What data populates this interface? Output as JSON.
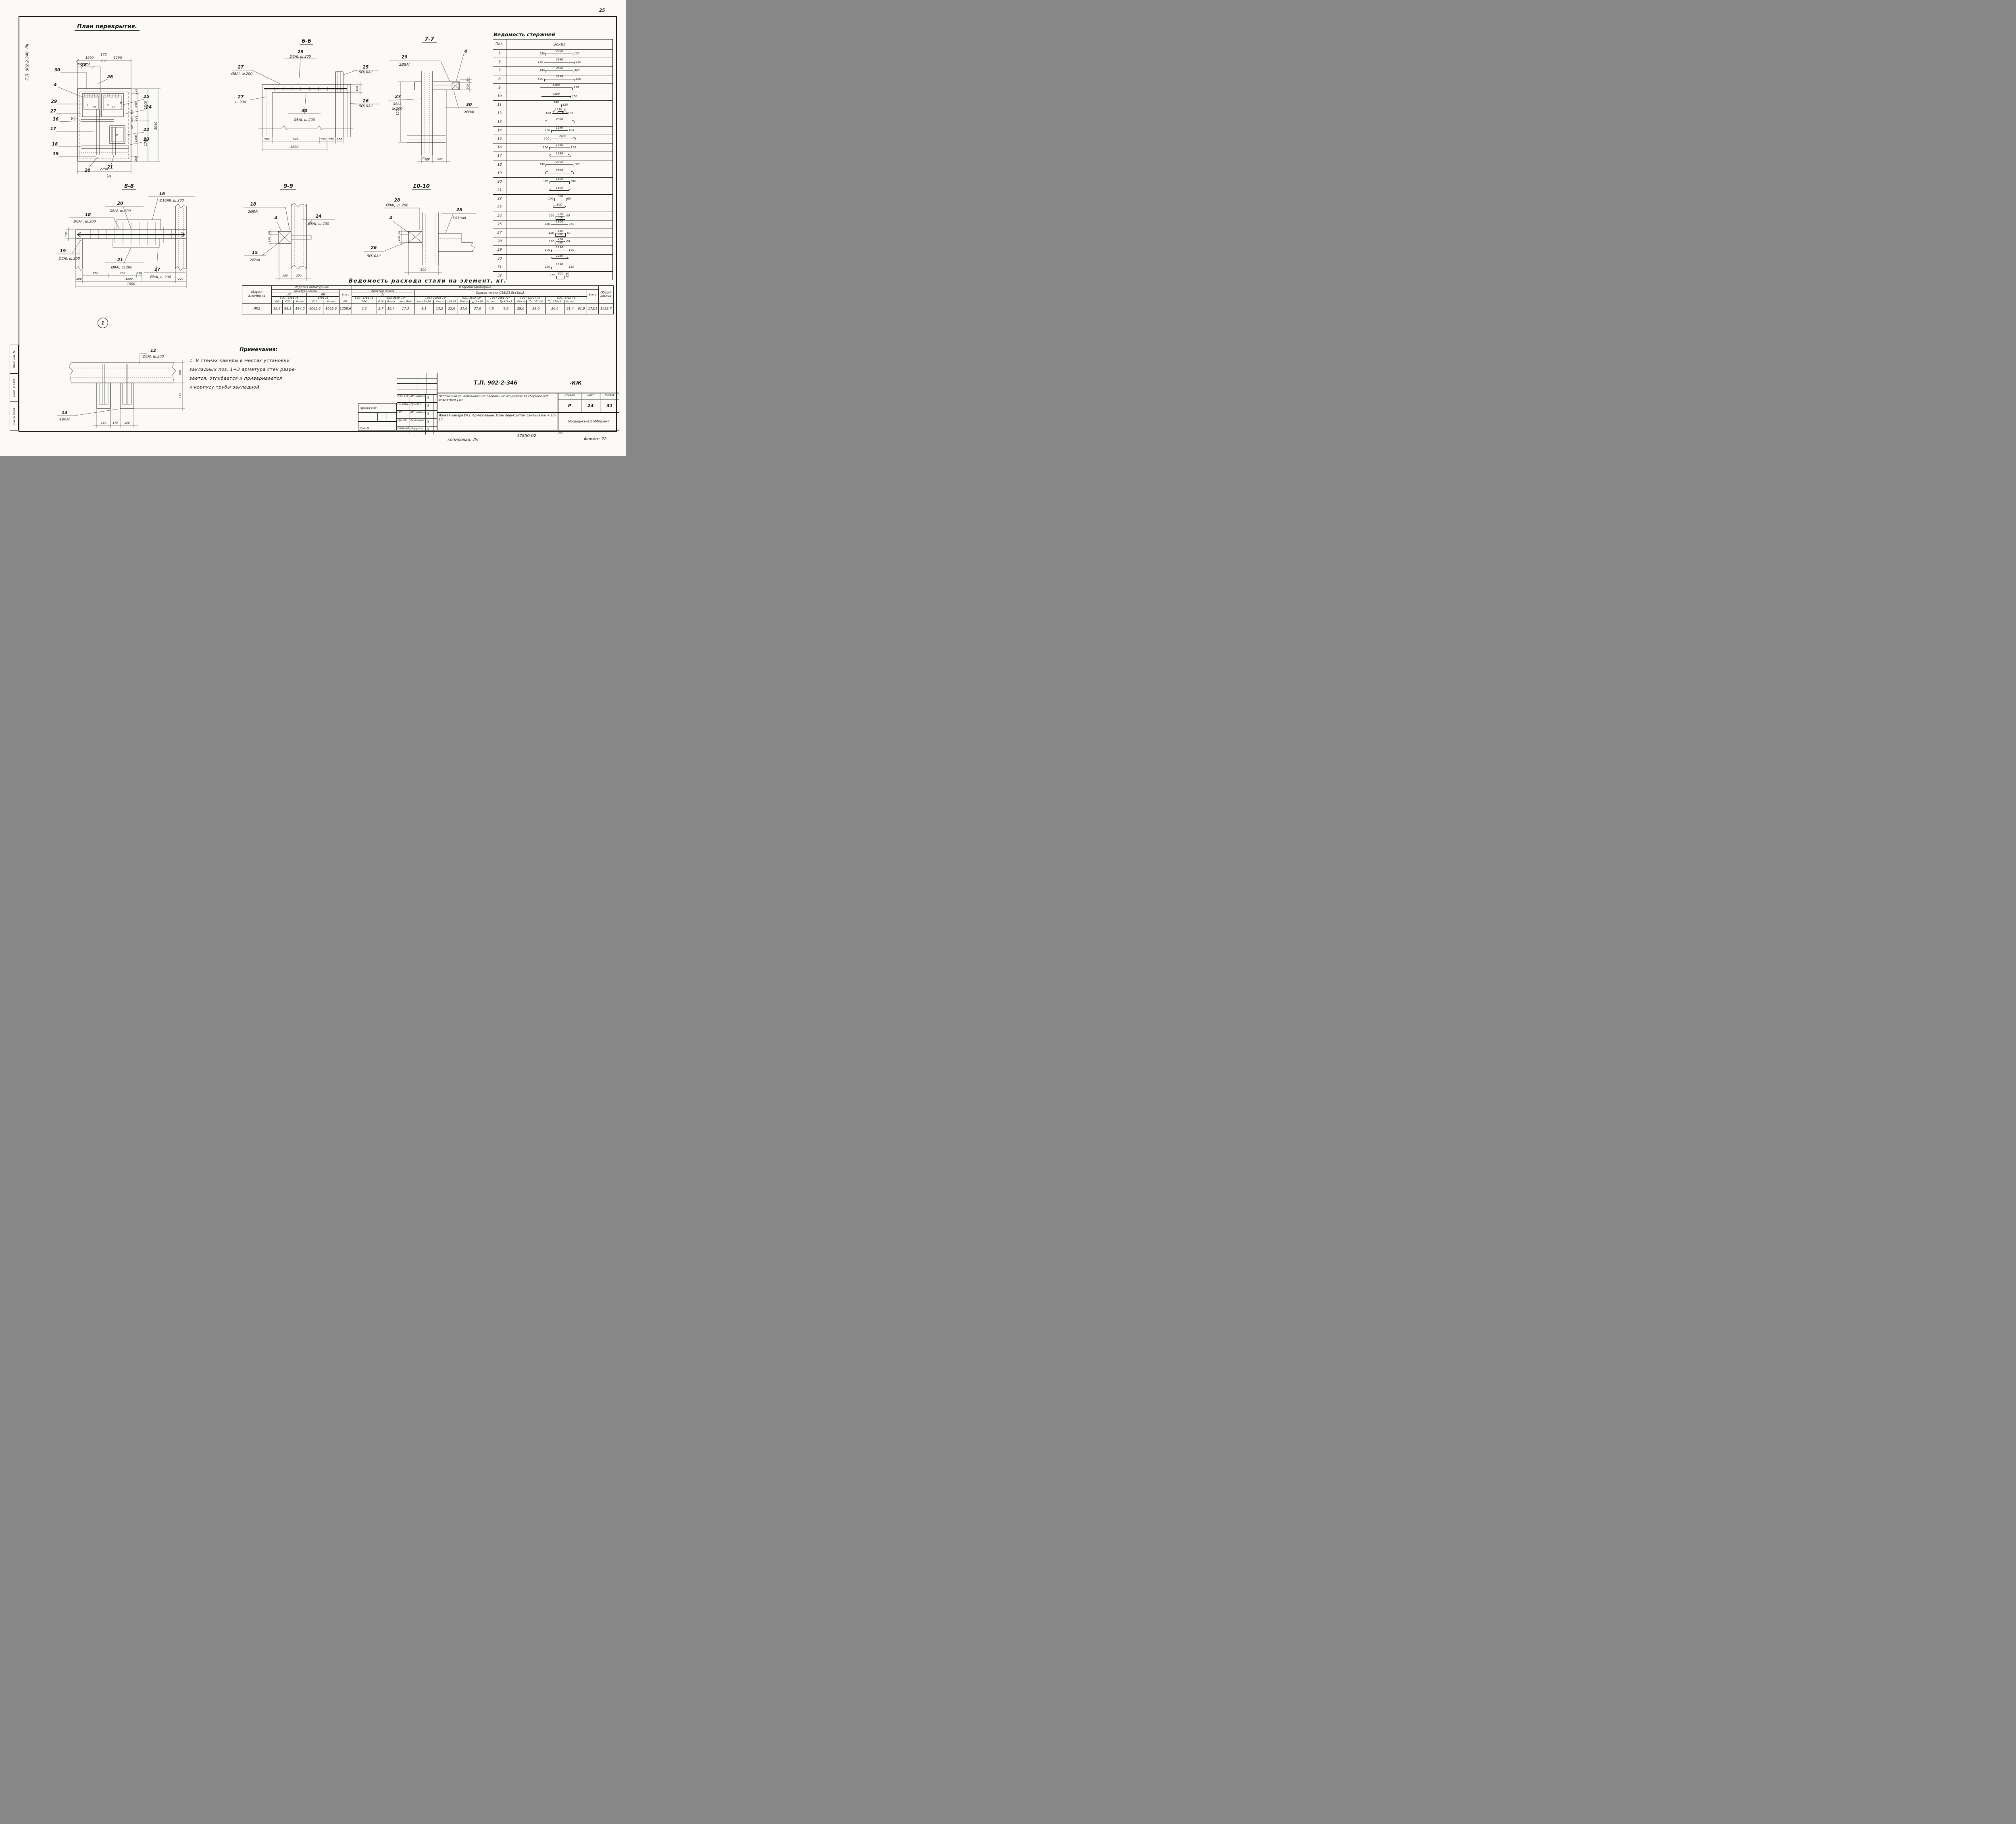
{
  "page": {
    "number": "25",
    "stamp": "-Т.П. 902-2-346. ЛII",
    "margin": [
      "Взам. инв. №",
      "Подп. и дата",
      "Инв. № подл."
    ],
    "footer": {
      "copied": "копировал: Лs",
      "order": "17850-02",
      "num": "26",
      "format": "Формат 22"
    }
  },
  "plan": {
    "title": "План перекрытия.",
    "balloon": "1",
    "callouts": {
      "30": "30",
      "28": "28",
      "26": "26",
      "4": "4",
      "29": "29",
      "27": "27",
      "25": "25",
      "24": "24",
      "22": "22",
      "23": "23",
      "16": "16",
      "17": "17",
      "18": "18",
      "19": "19",
      "20": "20",
      "21": "21"
    },
    "marks": {
      "m6": "6",
      "m8": "8",
      "b7": "7",
      "b8": "8",
      "b9": "9",
      "b9b": "9",
      "b10": "10",
      "b10b": "10"
    },
    "dims": {
      "top": [
        "1290",
        "170",
        "1290"
      ],
      "top2": [
        "200",
        "700"
      ],
      "right": [
        "200",
        "940",
        "200",
        "1500",
        "200"
      ],
      "mid": [
        "1340",
        "1700"
      ],
      "total": "3040",
      "bottom": "2750",
      "inner": [
        "150",
        "700",
        "200"
      ]
    }
  },
  "s66": {
    "title": "6-6",
    "a29": "29",
    "a29s": "Ø8AI, ш.200",
    "a27": "27",
    "a27s": "Ø8AI, ш.200",
    "a27b": "27",
    "a27bs": "ш.200",
    "a25": "25",
    "a25s": "5Ø10AII",
    "a26": "26",
    "a26s": "5Ø10AII",
    "a30": "30",
    "a30s": "Ø8AI, ш 200",
    "d": [
      "200",
      "940",
      "150",
      "170",
      "150"
    ],
    "total": "1290",
    "v": "100"
  },
  "s77": {
    "title": "7-7",
    "a29": "29",
    "a29s": "2Ø8AI",
    "a4": "4",
    "a27": "27",
    "a27s1": "Ø8AI,",
    "a27s2": "ш.200",
    "a30": "30",
    "a30s": "2Ø8AI",
    "d800": "800",
    "d30": "30",
    "d100": "100",
    "d200": "200",
    "d240": "240"
  },
  "s88": {
    "title": "8-8",
    "a16": "16",
    "a16s": "Ø10AII, ш.200",
    "a20": "20",
    "a20s": "Ø8AI, ш.200",
    "a18": "18",
    "a18s": "Ø8AI , ш.200",
    "a19": "19",
    "a19s": "Ø8AI, ш.200",
    "a21": "21",
    "a21s": "Ø8AI, ш.200",
    "a17": "17",
    "a17s": "Ø8AI, ш.200",
    "v100": "100",
    "d": [
      "650",
      "700",
      "150"
    ],
    "d2": [
      "200",
      "1500",
      "200"
    ],
    "total": "1900"
  },
  "s99": {
    "title": "9-9",
    "a18": "18",
    "a18s": "2Ø8AI",
    "a4": "4",
    "a24": "24",
    "a24s": "Ø8AI, ш.200",
    "a15": "15",
    "a15s": "2Ø8AI",
    "d30": "30",
    "d100": "100",
    "d150": "150",
    "d200": "200"
  },
  "s10": {
    "title": "10-10",
    "a28": "28",
    "a28s": "Ø8AI, ш. 200",
    "a4": "4",
    "a25": "25",
    "a25s": "5Ø10AII",
    "a26": "26",
    "a26s": "5Ø10AII",
    "d30": "30",
    "d100": "100",
    "d390": "390"
  },
  "det": {
    "a12": "12",
    "a12s": "Ø8AI, ш.200",
    "a13": "13",
    "a13s": "4Ø8AI",
    "d200": "200",
    "d150": "150",
    "db": [
      "150",
      "170",
      "150"
    ]
  },
  "rods": {
    "title": "Ведомость стержней",
    "hpos": "Поз.",
    "hesk": "Эскиз",
    "rows": [
      {
        "pos": "5",
        "l": "150",
        "c": "2700",
        "r": "150"
      },
      {
        "pos": "6",
        "l": "150",
        "c": "2990",
        "r": "150"
      },
      {
        "pos": "7",
        "l": "500",
        "c": "2680",
        "r": "500"
      },
      {
        "pos": "8",
        "l": "500",
        "c": "2970",
        "r": "500"
      },
      {
        "pos": "9",
        "c": "5100",
        "r": "150"
      },
      {
        "pos": "10",
        "c": "4300",
        "r": "150"
      },
      {
        "pos": "11",
        "c": "500",
        "r": "150"
      },
      {
        "pos": "12",
        "l": "100",
        "d1": "310",
        "c": "110",
        "d2": "310",
        "r": "100"
      },
      {
        "pos": "13",
        "c": "2800"
      },
      {
        "pos": "14",
        "l": "100",
        "c": "1290",
        "r": "100"
      },
      {
        "pos": "15",
        "l": "100",
        "c": "2430"
      },
      {
        "pos": "16",
        "l": "150",
        "c": "1850",
        "r": "150"
      },
      {
        "pos": "17",
        "c": "1850"
      },
      {
        "pos": "18",
        "l": "100",
        "c": "2700",
        "r": "100"
      },
      {
        "pos": "19",
        "c": "2700"
      },
      {
        "pos": "20",
        "l": "100",
        "c": "1800",
        "r": "100"
      },
      {
        "pos": "21",
        "c": "1800"
      },
      {
        "pos": "22",
        "l": "100",
        "c": "800",
        "r": "60"
      },
      {
        "pos": "23",
        "c": "800"
      },
      {
        "pos": "24",
        "l": "120",
        "t": "370",
        "c": "310",
        "r": "60"
      },
      {
        "pos": "25",
        "l": "150",
        "c": "1300",
        "r": "150"
      },
      {
        "pos": "27",
        "l": "120",
        "t": "460",
        "c": "400",
        "r": "60"
      },
      {
        "pos": "28",
        "l": "120",
        "t": "410",
        "c": "350",
        "r": "60"
      },
      {
        "pos": "29",
        "l": "100",
        "c": "1250",
        "r": "100"
      },
      {
        "pos": "30",
        "c": "1250"
      },
      {
        "pos": "31",
        "l": "150",
        "c": "1290",
        "r": "150"
      },
      {
        "pos": "32",
        "l": "150",
        "t": "300",
        "r": "50",
        "r2": "50"
      }
    ]
  },
  "steel": {
    "title": "Ведомость расхода стали на элемент, кг.",
    "h": {
      "marka": "Марка элемента",
      "g1": "Изделия арматурные",
      "g2": "Изделия закладные",
      "klass": "Арматура класса",
      "klass2": "Арматура класса",
      "ai": "AI",
      "aii": "AII",
      "ai2": "AI",
      "gost_ai": "ГОСТ 5781-75",
      "gost_aii": "5781-75",
      "gost_z1": "ГОСТ 5781-75",
      "gost_z2": "ГОСТ 2590-71*",
      "prokat": "Прокат марки С38/23 8ст3кп2.",
      "g19903": "ГОСТ 19903-74*",
      "g8509": "ГОСТ 8509-72*",
      "g2591": "ГОСТ 2591-71*",
      "g10704": "ГОСТ 10704-76",
      "g8732": "ГОСТ 8732-78",
      "vsego": "Всего",
      "vsego2": "Всего",
      "obshy": "Общий расход",
      "cols": [
        "Ø8",
        "Ø20",
        "Итого",
        "Ø10",
        "Итого",
        "Ø8",
        "Ø10",
        "Ø16",
        "Итого",
        "лист б=8",
        "лист б=10",
        "Итого",
        "L63×5",
        "Итого",
        "□10×10",
        "Итого",
        "Тр 428×7",
        "Итого",
        "Тр. 351×9",
        "Тр. 273×8",
        "Итого"
      ]
    },
    "row": [
      "ИК2",
      "95,8",
      "88,2",
      "194,0",
      "1065,6",
      "1065,6",
      "1259,6",
      "3,2",
      "3,7",
      "10,4",
      "17,3",
      "9,1",
      "13,5",
      "22,6",
      "37,6",
      "37,6",
      "4,8",
      "4,8",
      "29,0",
      "29,0",
      "30,4",
      "31,4",
      "61,8",
      "173,1",
      "1432,7"
    ]
  },
  "notes": {
    "title": "Примечания:",
    "l1": "1. В стенах камеры в местах установки",
    "l2": "закладных поз. 1÷3  арматура  стен разре-",
    "l3": "зается, отгибается и приваривается",
    "l4": "к корпусу трубы закладной."
  },
  "tb": {
    "doc": "Т.П. 902-2-346",
    "suffix": "-КЖ",
    "privyazan": "Привязан:",
    "inv": "Инв. №",
    "rows": [
      [
        "Нач. отд",
        "Мешалкин"
      ],
      [
        "Гл. спец.",
        "Руссин"
      ],
      [
        "ГИП",
        "Мешалкин"
      ],
      [
        "Рук. бр.",
        "Болотова"
      ],
      [
        "Инженер",
        "Нарунец"
      ]
    ],
    "project": "Отстойники канализационные радиальные вторичные из сборного ж/б диаметром 18м",
    "stadia_l": "Стадия",
    "list_l": "Лист",
    "listov_l": "Листов",
    "stadia": "Р",
    "list": "24",
    "listov": "31",
    "sheet_title": "Иловая камера ИК2. Армирование. План перекрытия. Сечения 6-6 ÷ 10-10.",
    "org": "МосводоканалНИИпроект"
  }
}
